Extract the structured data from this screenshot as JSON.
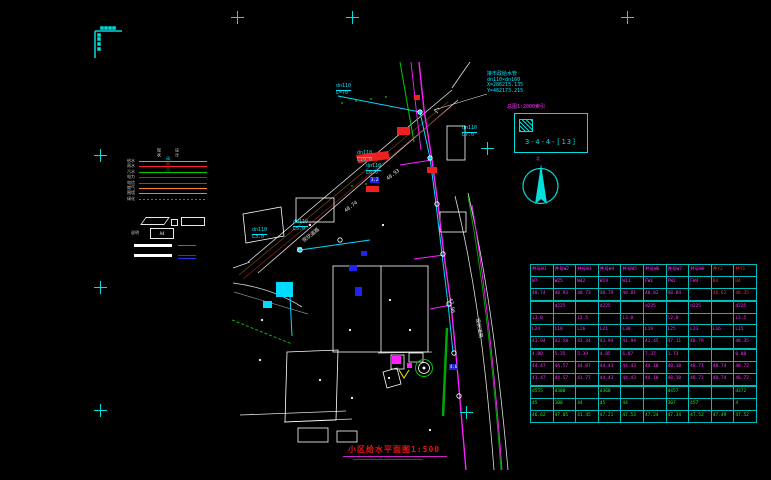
{
  "title": {
    "text": "小区给水平面图1:500"
  },
  "top_note": {
    "l1": "接市政给水管",
    "l2": "dn110×dn160",
    "l3": "X=286215.135",
    "l4": "Y=482173.215"
  },
  "index": {
    "note": "总图1:2000索引",
    "code": "3-4-4-[13]"
  },
  "north_label": "北",
  "legend": {
    "col_headers": [
      "现状",
      "设计"
    ],
    "rows": [
      {
        "label": "给水",
        "color": "#00dede",
        "dash": "solid",
        "sym": "阀"
      },
      {
        "label": "雨水",
        "color": "#ff2020",
        "dash": "solid",
        "sym": "雨"
      },
      {
        "label": "污水",
        "color": "#00cc00",
        "dash": "solid",
        "sym": "污"
      },
      {
        "label": "电力",
        "color": "#aa2222",
        "dash": "solid",
        "sym": ""
      },
      {
        "label": "电信",
        "color": "#884444",
        "dash": "solid",
        "sym": ""
      },
      {
        "label": "燃气",
        "color": "#ff8820",
        "dash": "solid",
        "sym": ""
      },
      {
        "label": "围墙",
        "color": "#9a9a9a",
        "dash": "solid",
        "sym": ""
      },
      {
        "label": "绿化",
        "color": "#00bb00",
        "dash": "dotted",
        "sym": ""
      }
    ],
    "note_label": "说明",
    "note_box_text": "A4"
  },
  "plan": {
    "crosses": [
      {
        "x": 237,
        "y": 17
      },
      {
        "x": 352,
        "y": 17
      },
      {
        "x": 627,
        "y": 17
      },
      {
        "x": 100,
        "y": 155
      },
      {
        "x": 100,
        "y": 287
      },
      {
        "x": 100,
        "y": 410
      },
      {
        "x": 487,
        "y": 148
      },
      {
        "x": 466,
        "y": 412
      }
    ],
    "pipe_labels": [
      {
        "dn": "dn110",
        "len": "L=70",
        "x": 336,
        "y": 84
      },
      {
        "dn": "dn110",
        "len": "L7.0",
        "x": 462,
        "y": 126
      },
      {
        "dn": "dn110",
        "len": "L19.0",
        "x": 357,
        "y": 151
      },
      {
        "dn": "dn110",
        "len": "L5.0",
        "x": 293,
        "y": 220
      },
      {
        "dn": "dn110",
        "len": "L3.0",
        "x": 252,
        "y": 228
      },
      {
        "dn": "dn110",
        "len": "L6.0",
        "x": 366,
        "y": 164
      }
    ],
    "texts": [
      {
        "t": "现状道路",
        "x": 302,
        "y": 240,
        "r": -38
      },
      {
        "t": "现状道路",
        "x": 479,
        "y": 318,
        "r": 80
      },
      {
        "t": "48.74",
        "x": 344,
        "y": 210,
        "r": -38
      },
      {
        "t": "48.93",
        "x": 386,
        "y": 178,
        "r": -38
      },
      {
        "t": "47.96",
        "x": 452,
        "y": 298,
        "r": 80
      }
    ],
    "blue_labels": [
      {
        "t": "4.6",
        "x": 449,
        "y": 364
      },
      {
        "t": "3.2",
        "x": 370,
        "y": 177
      }
    ]
  },
  "table": {
    "red_cols": [
      8,
      9
    ],
    "rows": [
      {
        "c": "m",
        "hdr": true,
        "sec": false,
        "cells": [
          "井号W1",
          "井号W2",
          "井号W3",
          "井号W4",
          "井号W5",
          "井号W6",
          "井号W7",
          "井号W8",
          "井Y2",
          "井Y1"
        ]
      },
      {
        "c": "m",
        "hdr": true,
        "sec": false,
        "cells": [
          "W7",
          "W25",
          "W42",
          "W19",
          "W11",
          "FW1",
          "FW2",
          "FW4",
          "B4",
          "D4"
        ]
      },
      {
        "c": "m",
        "hdr": true,
        "sec": true,
        "cells": [
          "48.74",
          "48.93",
          "48.73",
          "48.79",
          "48.81",
          "48.82",
          "48.84",
          "",
          "48.62",
          "48.35"
        ]
      },
      {
        "c": "m",
        "hdr": false,
        "sec": false,
        "cells": [
          "",
          "d225",
          "",
          "d225",
          "",
          "d225",
          "",
          "d225",
          "",
          "d225"
        ]
      },
      {
        "c": "m",
        "hdr": false,
        "sec": false,
        "cells": [
          "i3.0",
          "",
          "i2.5",
          "",
          "i3.0",
          "",
          "i2.0",
          "",
          "",
          "i3.5"
        ]
      },
      {
        "c": "m",
        "hdr": false,
        "sec": false,
        "cells": [
          "L24",
          "L18",
          "L26",
          "L21",
          "L30",
          "L19",
          "L25",
          "L23",
          "L16",
          "L15"
        ]
      },
      {
        "c": "m",
        "hdr": false,
        "sec": true,
        "cells": [
          "41.94",
          "43.58",
          "43.34",
          "43.94",
          "41.94",
          "41.45",
          "47.11",
          "48.79",
          "",
          "48.35"
        ]
      },
      {
        "c": "m",
        "hdr": false,
        "sec": false,
        "cells": [
          "4.80",
          "5.35",
          "5.39",
          "4.85",
          "6.87",
          "7.37",
          "1.73",
          "",
          "",
          "0.00"
        ]
      },
      {
        "c": "m",
        "hdr": false,
        "sec": false,
        "cells": [
          "44.47",
          "44.57",
          "44.07",
          "44.43",
          "44.43",
          "44.10",
          "48.10",
          "48.71",
          "48.74",
          "48.72"
        ]
      },
      {
        "c": "m",
        "hdr": false,
        "sec": true,
        "cells": [
          "41.47",
          "44.57",
          "41.77",
          "44.43",
          "44.43",
          "44.10",
          "48.10",
          "48.71",
          "48.74",
          "48.72"
        ]
      },
      {
        "c": "g",
        "hdr": false,
        "sec": false,
        "cells": [
          "d555",
          "d300",
          "",
          "d368",
          "",
          "",
          "d457",
          "",
          "",
          "d372"
        ]
      },
      {
        "c": "g",
        "hdr": false,
        "sec": false,
        "cells": [
          "45",
          "100",
          "44",
          "45",
          "44",
          "",
          "307",
          "457",
          "",
          "4"
        ]
      },
      {
        "c": "g",
        "hdr": false,
        "sec": false,
        "cells": [
          "46.62",
          "47.05",
          "41.45",
          "47.21",
          "47.53",
          "47.24",
          "47.34",
          "47.52",
          "47.49",
          "47.52"
        ]
      }
    ]
  }
}
